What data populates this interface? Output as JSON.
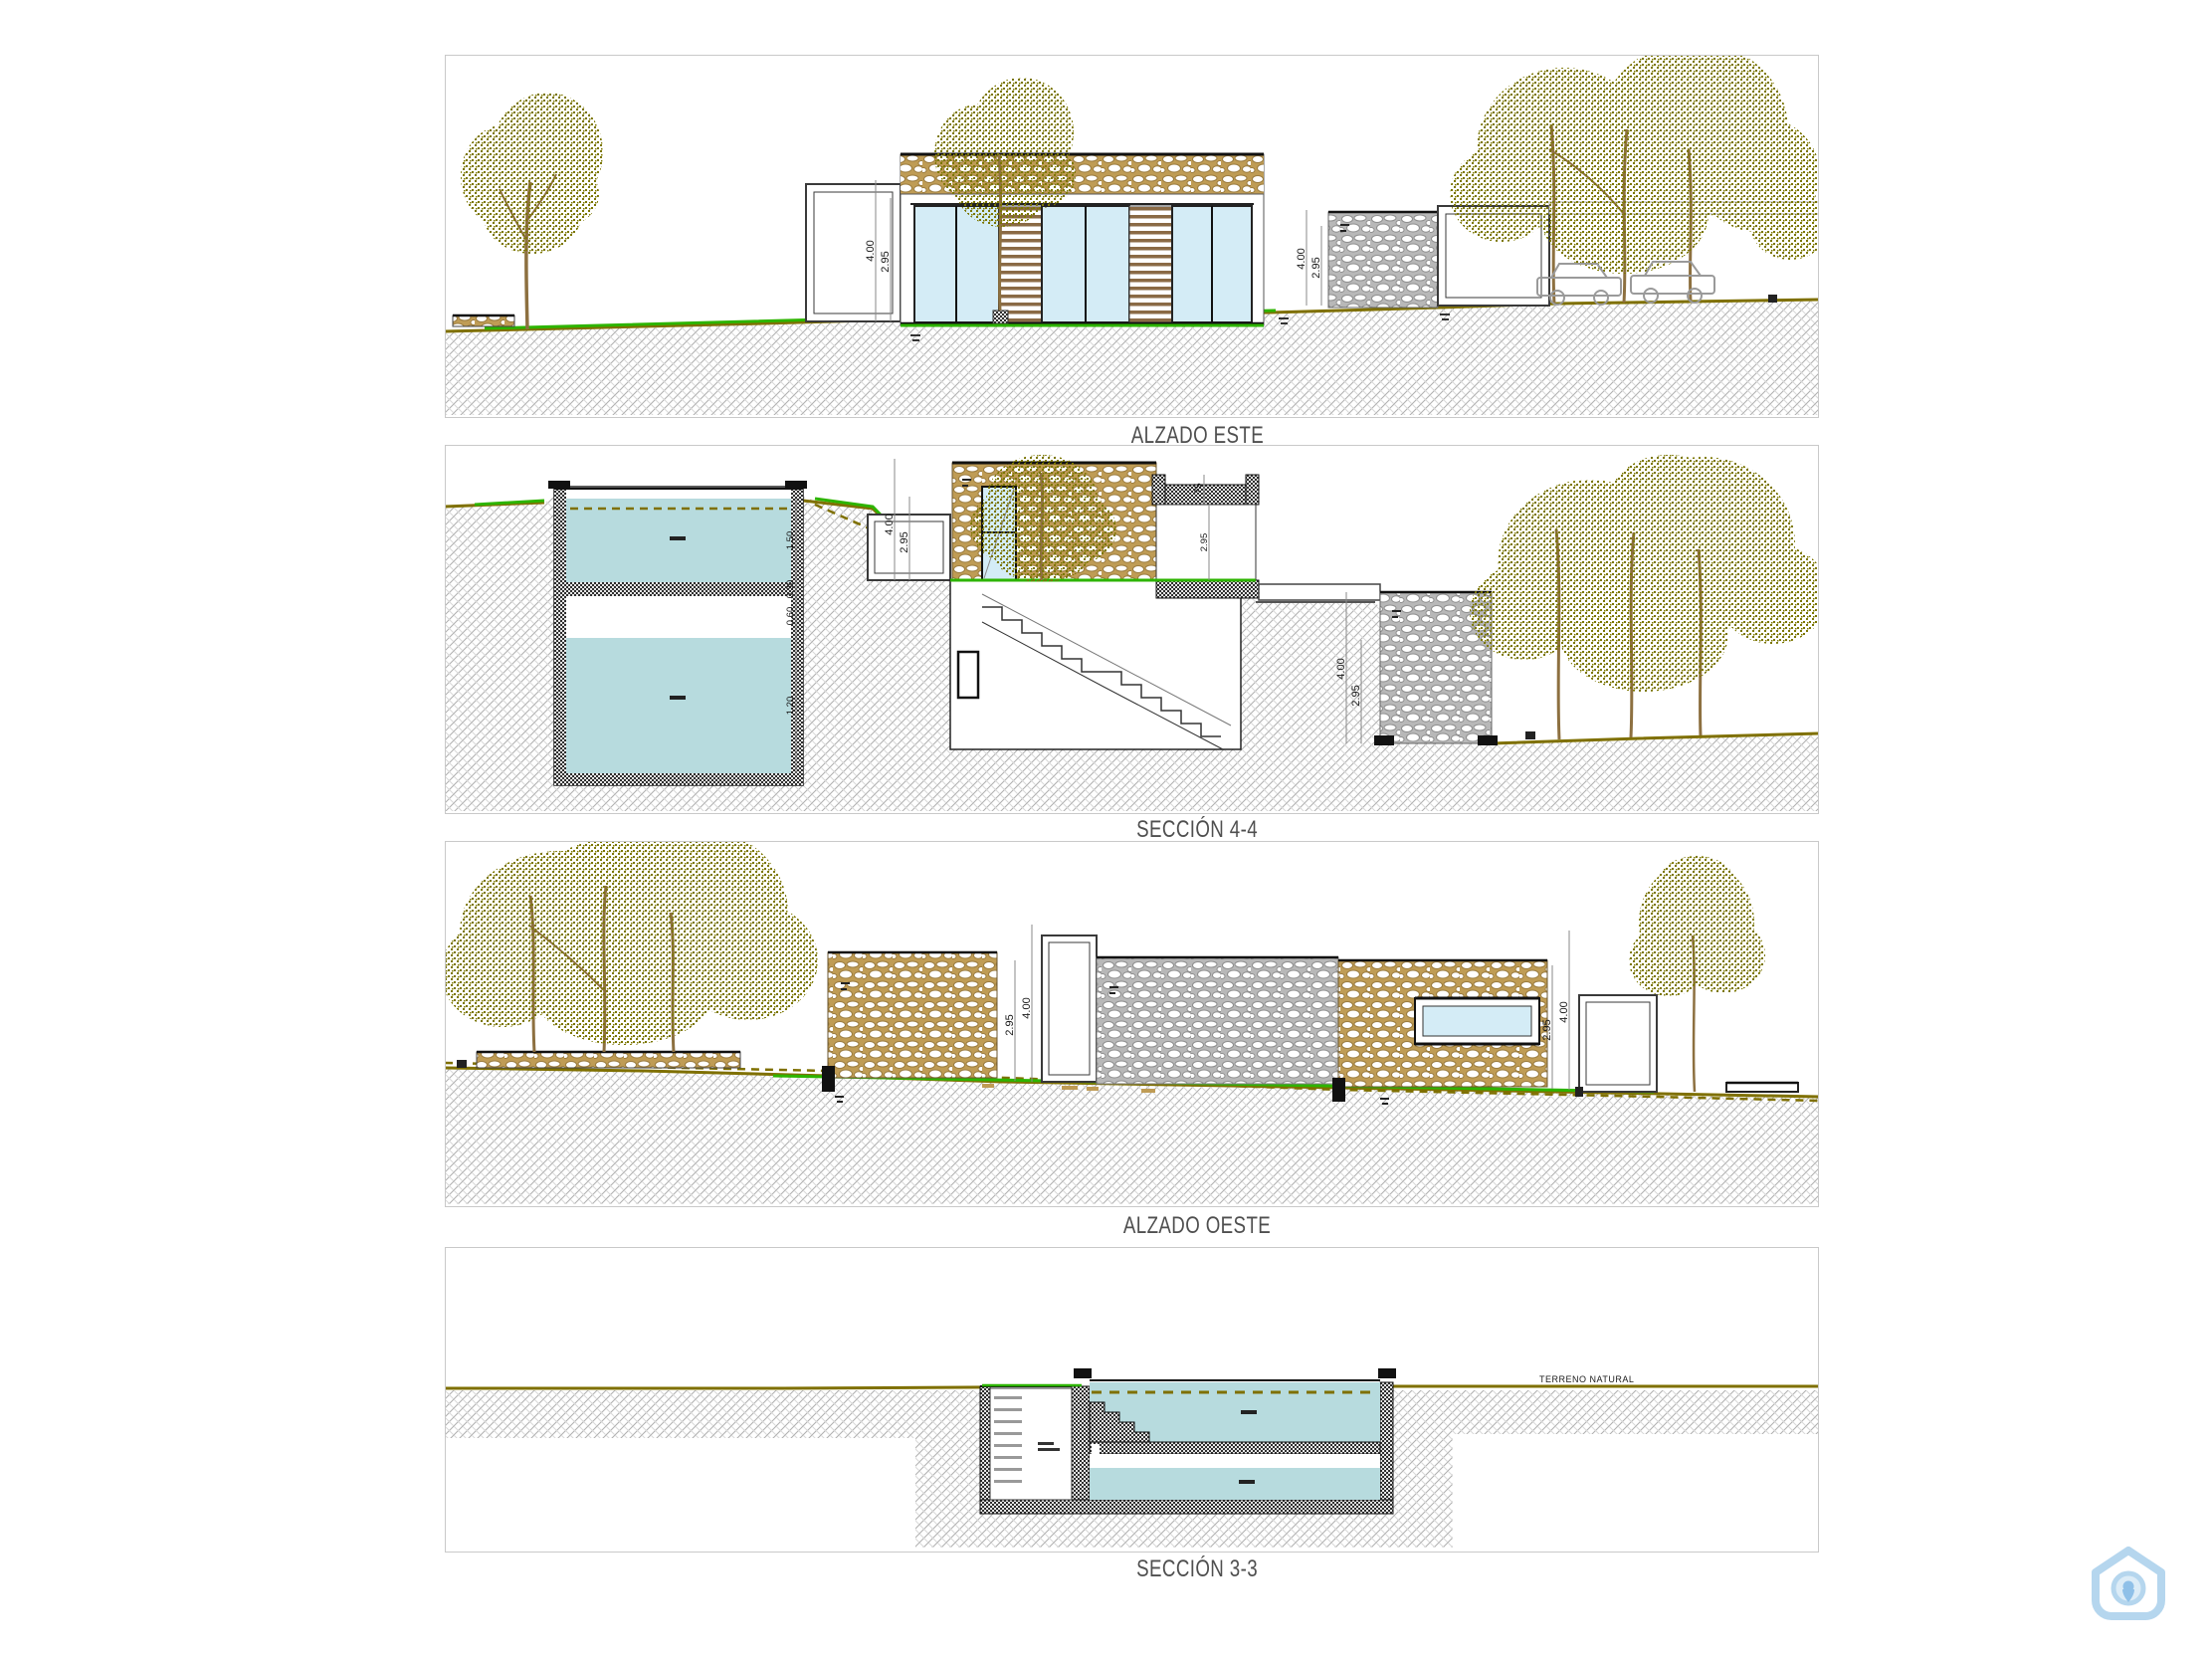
{
  "page": {
    "background": "#ffffff"
  },
  "colors": {
    "panel_border": "#c9c9c9",
    "ground_olive": "#7f7000",
    "grass_green": "#2db400",
    "water": "#b7dbde",
    "glass": "#d4ecf6",
    "stone_tan": "#bf9c55",
    "stone_gray": "#b8b8b8",
    "slat_brown": "#8a6a45",
    "foliage": "#7b7600",
    "trunk": "#8d7040",
    "title_text": "#4f4f4f",
    "dim_text": "#1a1a1a",
    "watermark": "#b5d6ee"
  },
  "panels": [
    {
      "id": "alzado-este",
      "title": "ALZADO ESTE",
      "dimensions": {
        "porch_outer": "4.00",
        "porch_inner": "2.95",
        "right_outer": "4.00",
        "right_inner": "2.95"
      }
    },
    {
      "id": "seccion-4-4",
      "title": "SECCIÓN 4-4",
      "dimensions": {
        "tank_upper": "1.50",
        "tank_mid_a": "0.30",
        "tank_mid_b": "0.60",
        "tank_lower": "1.20",
        "porch_outer": "4.00",
        "porch_inner": "2.95",
        "parapet": ".75",
        "opening": "2.95",
        "pillar_outer": "4.00",
        "pillar_inner": "2.95"
      }
    },
    {
      "id": "alzado-oeste",
      "title": "ALZADO OESTE",
      "dimensions": {
        "left_inner": "2.95",
        "left_outer": "4.00",
        "right_inner": "2.95",
        "right_outer": "4.00"
      }
    },
    {
      "id": "seccion-3-3",
      "title": "SECCIÓN 3-3",
      "annotations": {
        "terrain_label": "TERRENO NATURAL"
      }
    }
  ]
}
